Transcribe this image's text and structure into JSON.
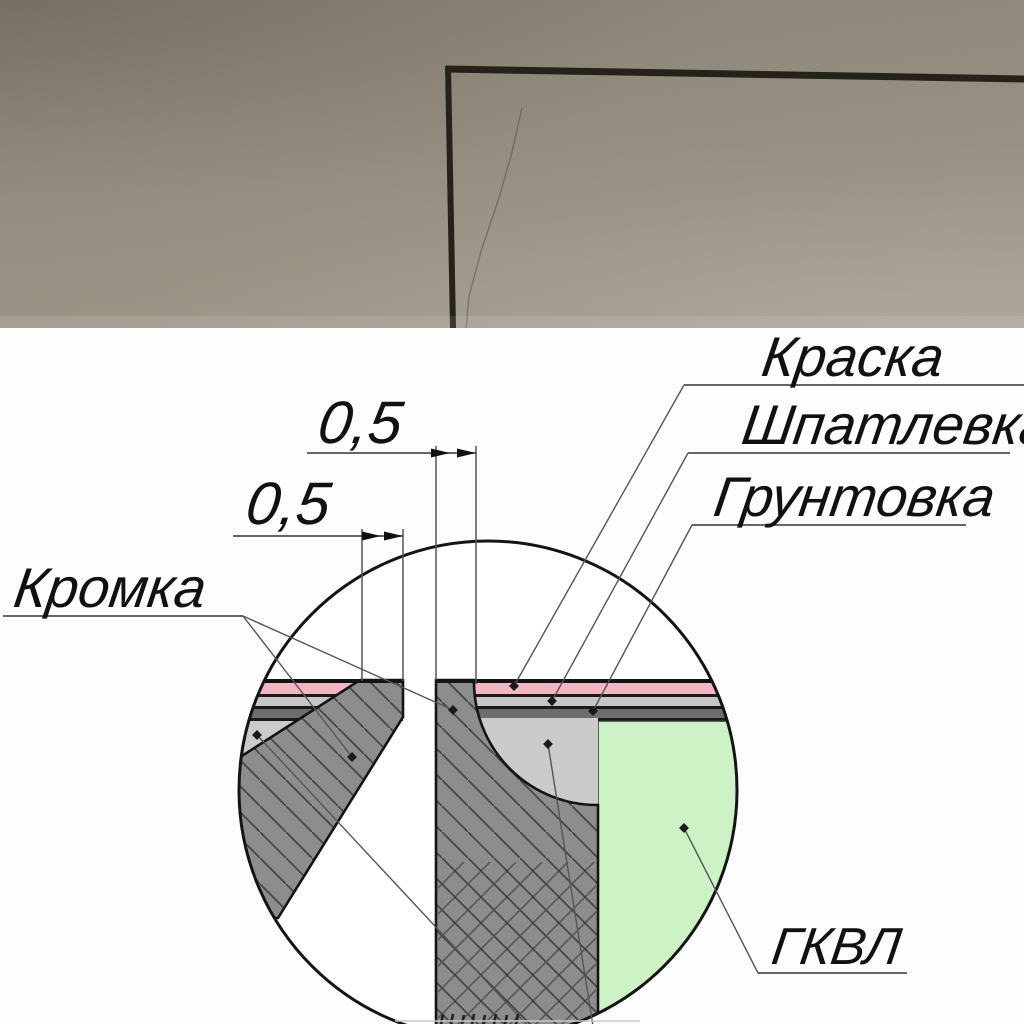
{
  "photo": {
    "wall_color": "#968e7f",
    "corner_line_color": "#25221c"
  },
  "diagram": {
    "background": "#ffffff",
    "labels": {
      "paint": "Краска",
      "filler": "Шпатлевка",
      "primer": "Грунтовка",
      "edge": "Кромка",
      "board": "ГКВЛ"
    },
    "dimensions": {
      "joint_flat_right": "0,5",
      "edge_flat_left": "0,5"
    },
    "colors": {
      "paint_layer": "#f2b6c3",
      "filler_layer": "#c6c6c6",
      "primer_layer": "#6e6e6e",
      "joint_filler": "#cbcbcb",
      "gypsum_board": "#8d8d8d",
      "gkvl_board": "#cdf2c6",
      "outline": "#141414"
    }
  }
}
